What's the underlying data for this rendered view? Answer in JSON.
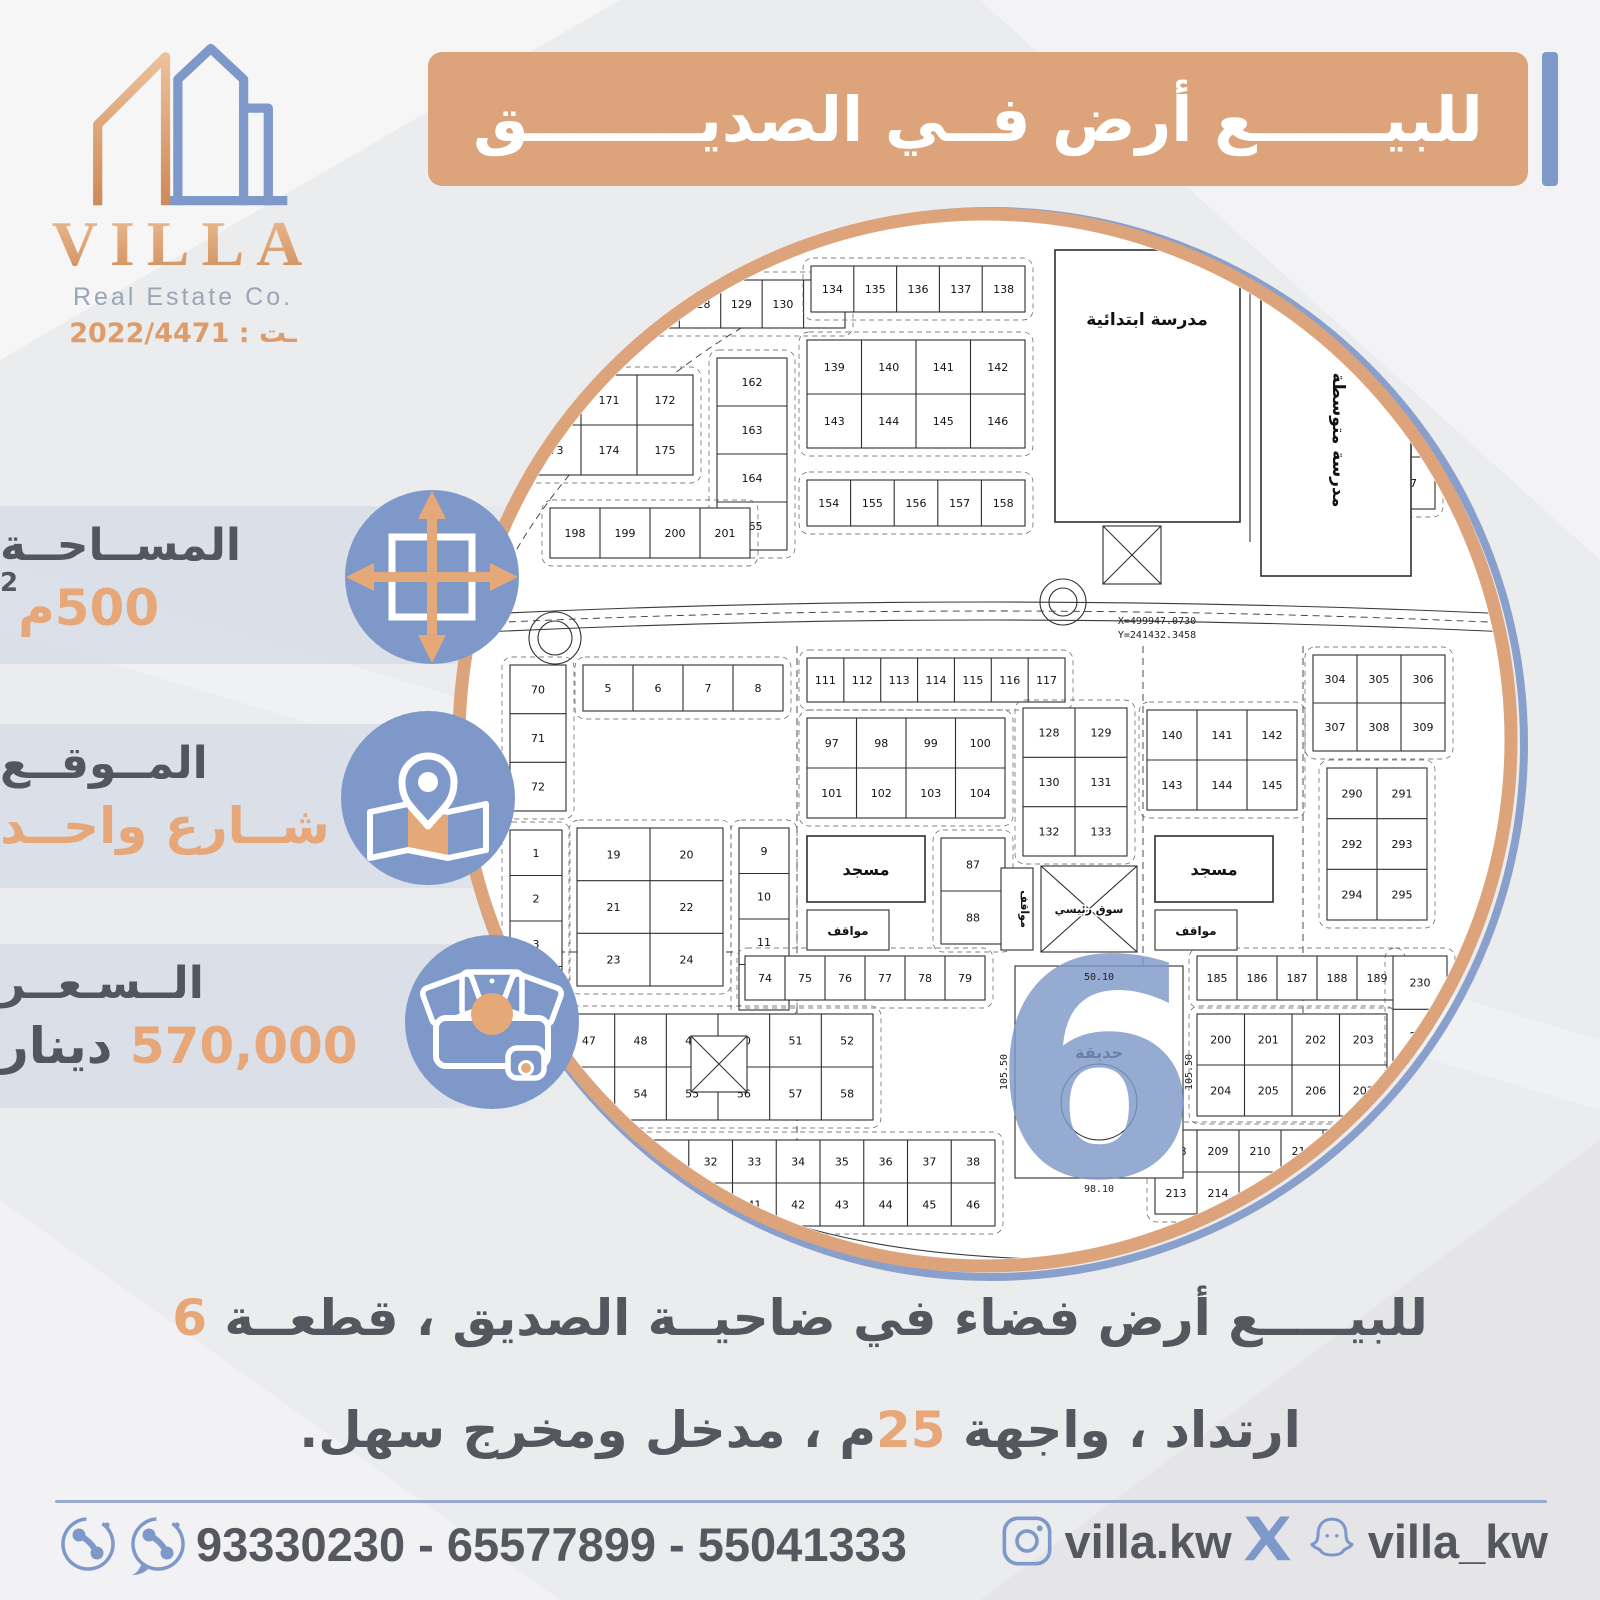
{
  "colors": {
    "orange": "#dda47b",
    "blue": "#7e99c9",
    "dark_text": "#55575f",
    "orange_text": "#e7a778"
  },
  "logo": {
    "name": "VILLA",
    "subtitle": "Real Estate Co.",
    "license": "ـت : 2022/4471"
  },
  "title": "للبيــــــع أرض فــي الصديــــــــق",
  "info": {
    "area": {
      "label": "المســاحــة",
      "value": "500م",
      "sup": "2"
    },
    "location": {
      "label": "المــوقــع",
      "value": "شــارع واحــد"
    },
    "price": {
      "label": "الــسـعــر",
      "value": "570,000",
      "unit": "دينار"
    }
  },
  "description": {
    "line1_pre": "للبيـــــع أرض فضاء في ضاحيــة الصديق ، قطعــة ",
    "line1_num": "6",
    "line2_pre": "ارتداد ، واجهة ",
    "line2_num": "25",
    "line2_post": "م ، مدخل ومخرج سهل."
  },
  "footer": {
    "phones": "93330230 - 65577899 - 55041333",
    "instagram": "villa.kw",
    "handle": "villa_kw"
  },
  "map": {
    "labels": {
      "school_primary": "مدرسة ابتدائية",
      "school_middle": "مدرسة متوسطة",
      "mosque": "مسجد",
      "parking": "مواقف",
      "park": "حديقة",
      "market": "سوق رئيسي",
      "block_number": "6"
    },
    "strips": [
      {
        "x": 100,
        "y": 70,
        "w": 290,
        "h": 48,
        "rows": 1,
        "cols": 7,
        "start": 125
      },
      {
        "x": 70,
        "y": 165,
        "w": 168,
        "h": 100,
        "rows": 2,
        "cols": 3,
        "start": 170
      },
      {
        "x": 262,
        "y": 148,
        "w": 70,
        "h": 192,
        "rows": 4,
        "cols": 1,
        "start": 162
      },
      {
        "x": 356,
        "y": 56,
        "w": 214,
        "h": 46,
        "rows": 1,
        "cols": 5,
        "start": 134
      },
      {
        "x": 352,
        "y": 130,
        "w": 218,
        "h": 108,
        "rows": 2,
        "cols": 4,
        "start": 139
      },
      {
        "x": 352,
        "y": 270,
        "w": 218,
        "h": 46,
        "rows": 1,
        "cols": 5,
        "start": 154
      },
      {
        "x": 95,
        "y": 298,
        "w": 200,
        "h": 50,
        "rows": 1,
        "cols": 4,
        "start": 198
      },
      {
        "x": 930,
        "y": 195,
        "w": 50,
        "h": 104,
        "rows": 2,
        "cols": 1,
        "start": 96
      },
      {
        "x": 55,
        "y": 455,
        "w": 56,
        "h": 146,
        "rows": 3,
        "cols": 1,
        "start": 70
      },
      {
        "x": 128,
        "y": 455,
        "w": 200,
        "h": 46,
        "rows": 1,
        "cols": 4,
        "start": 5
      },
      {
        "x": 55,
        "y": 620,
        "w": 52,
        "h": 182,
        "rows": 4,
        "cols": 1,
        "start": 1
      },
      {
        "x": 122,
        "y": 618,
        "w": 146,
        "h": 158,
        "rows": 3,
        "cols": 2,
        "start": 19
      },
      {
        "x": 284,
        "y": 618,
        "w": 50,
        "h": 182,
        "rows": 4,
        "cols": 1,
        "start": 9
      },
      {
        "x": 352,
        "y": 448,
        "w": 258,
        "h": 44,
        "rows": 1,
        "cols": 7,
        "start": 111
      },
      {
        "x": 352,
        "y": 508,
        "w": 198,
        "h": 100,
        "rows": 2,
        "cols": 4,
        "start": 97
      },
      {
        "x": 568,
        "y": 498,
        "w": 104,
        "h": 148,
        "rows": 3,
        "cols": 2,
        "start": 128
      },
      {
        "x": 692,
        "y": 500,
        "w": 150,
        "h": 100,
        "rows": 2,
        "cols": 3,
        "start": 140
      },
      {
        "x": 858,
        "y": 445,
        "w": 132,
        "h": 96,
        "rows": 2,
        "cols": 3,
        "start": 304
      },
      {
        "x": 872,
        "y": 558,
        "w": 100,
        "h": 152,
        "rows": 3,
        "cols": 2,
        "start": 290
      },
      {
        "x": 486,
        "y": 628,
        "w": 64,
        "h": 106,
        "rows": 2,
        "cols": 1,
        "start": 87
      },
      {
        "x": 290,
        "y": 746,
        "w": 240,
        "h": 44,
        "rows": 1,
        "cols": 6,
        "start": 74
      },
      {
        "x": 108,
        "y": 804,
        "w": 310,
        "h": 106,
        "rows": 2,
        "cols": 6,
        "start": 47
      },
      {
        "x": 190,
        "y": 930,
        "w": 350,
        "h": 86,
        "rows": 2,
        "cols": 8,
        "start": 31
      },
      {
        "x": 742,
        "y": 746,
        "w": 200,
        "h": 44,
        "rows": 1,
        "cols": 5,
        "start": 185
      },
      {
        "x": 742,
        "y": 804,
        "w": 190,
        "h": 102,
        "rows": 2,
        "cols": 4,
        "start": 200
      },
      {
        "x": 700,
        "y": 920,
        "w": 210,
        "h": 84,
        "rows": 2,
        "cols": 5,
        "start": 208
      },
      {
        "x": 938,
        "y": 746,
        "w": 54,
        "h": 160,
        "rows": 3,
        "cols": 1,
        "start": 230
      }
    ],
    "schools": [
      {
        "x": 600,
        "y": 40,
        "w": 185,
        "h": 272,
        "label": "school_primary",
        "rot": 0,
        "tx": 692,
        "ty": 115
      },
      {
        "x": 806,
        "y": 88,
        "w": 150,
        "h": 278,
        "label": "school_middle",
        "rot": 90,
        "tx": 878,
        "ty": 230
      }
    ],
    "mosques": [
      {
        "x": 352,
        "y": 626,
        "w": 118,
        "h": 66
      },
      {
        "x": 700,
        "y": 626,
        "w": 118,
        "h": 66
      }
    ],
    "parkings": [
      {
        "x": 352,
        "y": 700,
        "w": 82,
        "h": 40
      },
      {
        "x": 700,
        "y": 700,
        "w": 82,
        "h": 40
      }
    ],
    "market": {
      "x": 586,
      "y": 656,
      "w": 96,
      "h": 86
    },
    "vparking": {
      "x": 546,
      "y": 658,
      "w": 32,
      "h": 82
    },
    "park": {
      "x": 560,
      "y": 756,
      "w": 168,
      "h": 212
    },
    "xboxes": [
      {
        "x": 648,
        "y": 316,
        "w": 58,
        "h": 58
      },
      {
        "x": 236,
        "y": 826,
        "w": 56,
        "h": 56
      }
    ],
    "roundabouts": [
      {
        "cx": 100,
        "cy": 428,
        "r": 26
      },
      {
        "cx": 608,
        "cy": 392,
        "r": 23
      }
    ],
    "six": {
      "x": 640,
      "y": 862
    },
    "small_texts": [
      {
        "t": "X=499947.0730",
        "x": 702,
        "y": 414,
        "r": 0
      },
      {
        "t": "Y=241432.3458",
        "x": 702,
        "y": 428,
        "r": 0
      },
      {
        "t": "105.50",
        "x": 552,
        "y": 862,
        "r": -90
      },
      {
        "t": "105.50",
        "x": 737,
        "y": 862,
        "r": -90
      },
      {
        "t": "98.10",
        "x": 644,
        "y": 982,
        "r": 0
      },
      {
        "t": "50.10",
        "x": 644,
        "y": 770,
        "r": 0
      }
    ]
  }
}
